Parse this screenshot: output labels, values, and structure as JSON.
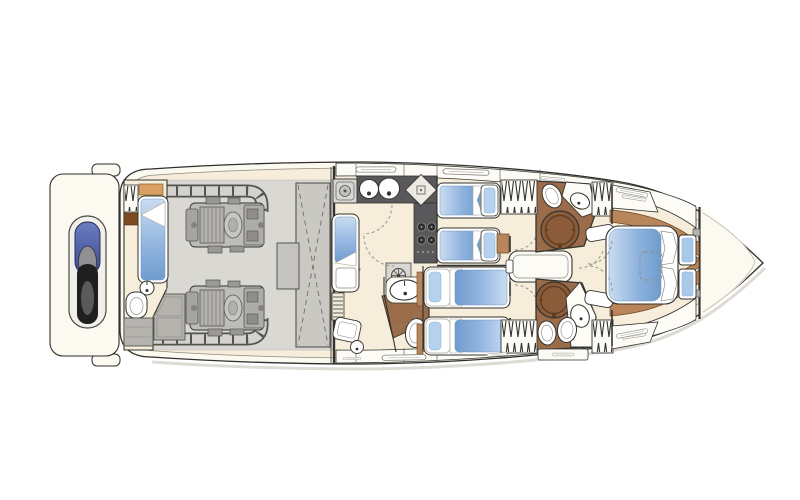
{
  "plan": {
    "type": "yacht-lower-deck-floor-plan",
    "orientation": "bow-right",
    "rooms": [
      "swim-platform",
      "crew-cabin",
      "engine-room",
      "galley",
      "lower-lobby",
      "day-head",
      "twin-cabin-port",
      "twin-cabin-starboard",
      "bathroom-port",
      "bathroom-starboard",
      "corridor",
      "master-cabin",
      "foredeck"
    ],
    "equipment_counts": {
      "engines": 2,
      "single_beds": 5,
      "double_beds": 1,
      "circular_showers": 2,
      "toilets": 5,
      "round_galley_sinks": 2,
      "hob_burners": 4,
      "hanging_lockers": 5,
      "tenders": 1
    }
  },
  "icons": {
    "jet-ski-icon": "tender capsule on swim platform",
    "engine-icon": "ribbed machinery block",
    "fuel-tank-icon": "rectangle with dashed X",
    "exhaust-pipe-icon": "ticked pipe run",
    "sink-icon": "oval basin with tap dot",
    "round-sink-icon": "circle with tap dot",
    "toilet-icon": "oval bowl",
    "shower-icon": "circular shower pan",
    "cooktop-icon": "four burner circles",
    "hanging-locker-icon": "zigzag rail",
    "stairs-icon": "slatted treads",
    "door-swing-icon": "dashed arc",
    "deck-hatch-icon": "dashed rounded rectangle",
    "washing-machine-icon": "square with porthole",
    "vent-icon": "circle with spokes",
    "window-icon": "thin lozenge"
  },
  "palette": {
    "paper": "#ffffff",
    "hullFill": "#fbf9f0",
    "hullLine": "#2f2f2b",
    "innerLine": "#8d897b",
    "deckFloor": "#f6eedb",
    "bandFill": "#fcfbf5",
    "engineFloor": "#d9d8d3",
    "engineBody": "#bdbcb8",
    "pipeDark": "#54534e",
    "pipeFill": "#d3d2ce",
    "tankFill": "#c9c8c3",
    "cabinetGray": "#b4b3ae",
    "counterDark": "#59595b",
    "applianceFill": "#d8d7d3",
    "woodFloor": "#9a6c4a",
    "showerFill": "#8a5c39",
    "showerRing": "#5e3d24",
    "woodTrim": "#b9855a",
    "woodDark": "#7c4b21",
    "shelfTan": "#d99f63",
    "blueLight": "#c9dcf1",
    "blue": "#8fb3de",
    "blueDark": "#6f9ccd",
    "windowBlue": "#a9c9e9",
    "fixtureFill": "#ffffff",
    "lineDark": "#34332f",
    "dashLine": "#8f8c80",
    "jetskiNavy": "#3d4c94",
    "jetskiNavyLight": "#6b7cc0",
    "jetskiDark": "#1f1f1f",
    "jetskiGray": "#8f8f95",
    "shadow": "#d5d2c8"
  }
}
